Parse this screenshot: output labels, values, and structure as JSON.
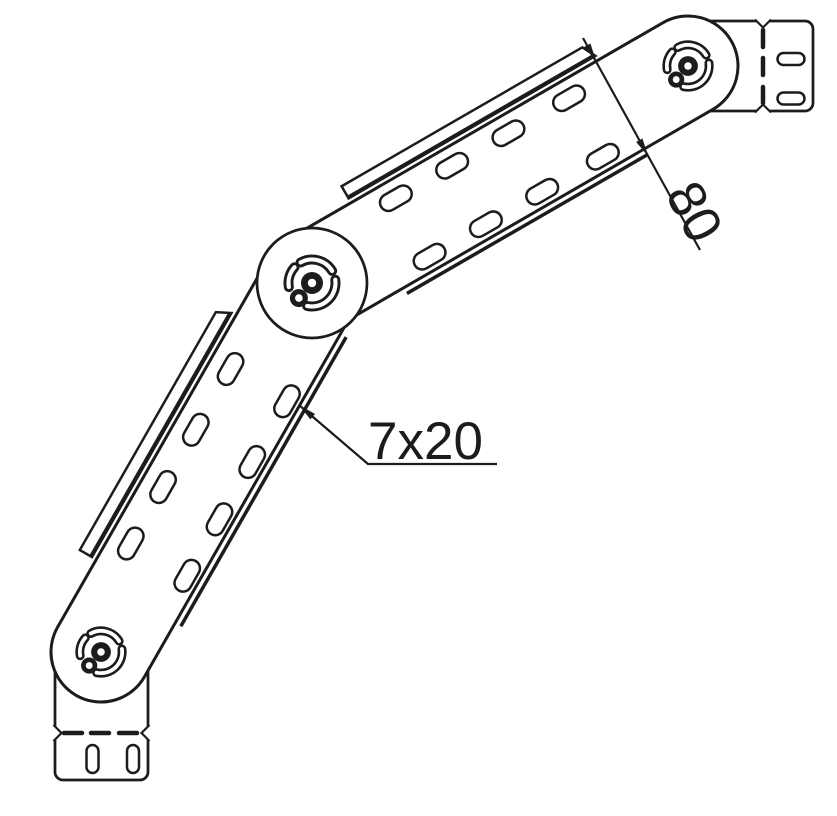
{
  "labels": {
    "width_dimension": "80",
    "slot_size": "7x20"
  },
  "colors": {
    "background": "#ffffff",
    "line": "#1c1c1c"
  },
  "drawing": {
    "canvas": {
      "width": 837,
      "height": 816
    },
    "hinges": [
      {
        "id": "hinge-bottom",
        "cx": 101,
        "cy": 652,
        "r": 50,
        "disc": false,
        "pivot_scale": 0.9
      },
      {
        "id": "hinge-middle",
        "cx": 312,
        "cy": 283,
        "r": 55,
        "disc": true,
        "pivot_scale": 1
      },
      {
        "id": "hinge-top",
        "cx": 688,
        "cy": 66,
        "r": 50,
        "disc": false,
        "pivot_scale": 0.9
      }
    ],
    "pivot": {
      "hub_r": 11,
      "hub_hole_r": 4.2,
      "sat_r": 9,
      "sat_hole_r": 3.8,
      "sat_dist": 20,
      "sat_angle_deg": 131,
      "arc_r": 23.5,
      "arc_outer_w": 10,
      "arc_inner_w": 4.2,
      "arcs": [
        {
          "center_deg": -75,
          "half_deg": 44
        },
        {
          "center_deg": 47,
          "half_deg": 55
        },
        {
          "center_deg": 196,
          "half_deg": 26
        }
      ]
    },
    "segments": [
      {
        "id": "segment-lower",
        "from": [
          101,
          652
        ],
        "to": [
          312,
          283
        ],
        "half_width": 50,
        "slot_cols": [
          109,
          174,
          240,
          310
        ],
        "slot_rows": [
          -28,
          37
        ],
        "band": {
          "from": 78,
          "to": 352,
          "outer": 69,
          "inner": 55,
          "bevel": 7
        },
        "rail": {
          "from": 62,
          "to": 395,
          "offset": 56.5
        }
      },
      {
        "id": "segment-upper",
        "from": [
          312,
          283
        ],
        "to": [
          688,
          66
        ],
        "half_width": 50,
        "slot_cols": [
          115,
          180,
          245,
          315
        ],
        "slot_rows": [
          -31.5,
          36
        ],
        "band": {
          "from": 74,
          "to": 352,
          "outer": 69,
          "inner": 55,
          "bevel": 7
        },
        "rail": {
          "from": 77,
          "to": 354,
          "offset": 56.5
        }
      }
    ],
    "slot": {
      "length": 34,
      "width": 17
    },
    "tongues": [
      {
        "id": "end-connector-bottom",
        "x": 55,
        "y": 660,
        "w": 93,
        "h": 120,
        "corner_r": 8,
        "fold": {
          "axis": "y",
          "pos": 733,
          "dashes": [
            [
              64,
              82
            ],
            [
              91,
              109
            ],
            [
              119,
              137
            ]
          ]
        },
        "slot_w": 12,
        "slot_h": 28,
        "slots": [
          {
            "cx": 92.5,
            "cy": 759
          },
          {
            "cx": 133,
            "cy": 759
          }
        ]
      },
      {
        "id": "end-connector-right",
        "x": 700,
        "y": 21,
        "w": 113,
        "h": 90,
        "corner_r": 8,
        "fold": {
          "axis": "x",
          "pos": 763,
          "dashes": [
            [
              30,
              47
            ],
            [
              58,
              75
            ],
            [
              87,
              103
            ]
          ]
        },
        "slot_w": 27,
        "slot_h": 12,
        "slots": [
          {
            "cx": 791,
            "cy": 59
          },
          {
            "cx": 791,
            "cy": 98.5
          }
        ]
      }
    ],
    "dimension": {
      "line": [
        [
          583,
          38
        ],
        [
          700,
          250
        ]
      ],
      "arrow_tips": [
        [
          596,
          61
        ],
        [
          648,
          156
        ]
      ],
      "arrow_angle_deg": 61.1,
      "label_x": 694,
      "label_y": 212,
      "label_rot": 62
    },
    "leader": {
      "points": [
        [
          299,
          405
        ],
        [
          368,
          464
        ],
        [
          497,
          464
        ]
      ],
      "arrow_angle_deg": 220.5,
      "label_x": 368,
      "label_y": 459
    }
  }
}
